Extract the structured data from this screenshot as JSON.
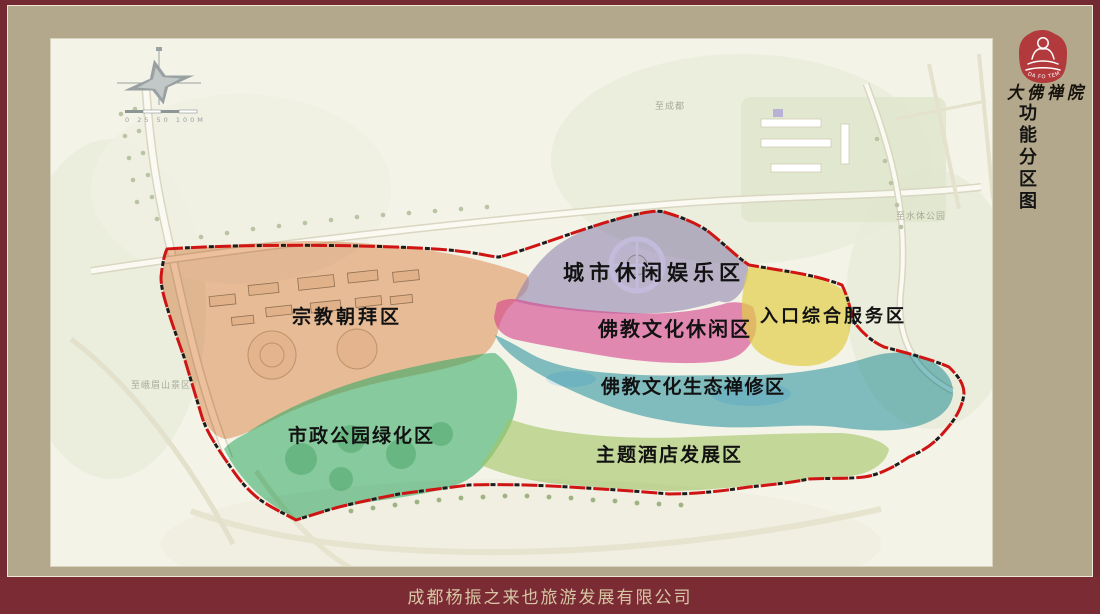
{
  "frame": {
    "maroon": "#732a33",
    "mat_tan": "#b3a88b"
  },
  "sidebar": {
    "seal_arc_text": "DA FO TEMPLE",
    "seal_color": "#b23a3c",
    "calligraphy": "大佛禅院",
    "vertical_title": "功能分区图"
  },
  "footer": {
    "company": "成都杨振之来也旅游发展有限公司"
  },
  "compass": {
    "scale_label": "0 25 50 100M"
  },
  "map": {
    "boundary_color": "#cf1414",
    "zones": [
      {
        "id": "religious-worship",
        "label": "宗教朝拜区",
        "color": "#e5945c"
      },
      {
        "id": "urban-leisure",
        "label": "城市休闲娱乐区",
        "color": "#8f84c0"
      },
      {
        "id": "buddhist-leisure",
        "label": "佛教文化休闲区",
        "color": "#e0459a"
      },
      {
        "id": "entrance-service",
        "label": "入口综合服务区",
        "color": "#ecd84e"
      },
      {
        "id": "eco-meditation",
        "label": "佛教文化生态禅修区",
        "color": "#2f9cb0"
      },
      {
        "id": "municipal-park",
        "label": "市政公园绿化区",
        "color": "#2eb06a"
      },
      {
        "id": "theme-hotel",
        "label": "主题酒店发展区",
        "color": "#a8cf6e"
      }
    ],
    "road_labels": [
      {
        "text": "至成都"
      },
      {
        "text": "至水体公园"
      },
      {
        "text": "至峨眉山景区"
      }
    ]
  }
}
